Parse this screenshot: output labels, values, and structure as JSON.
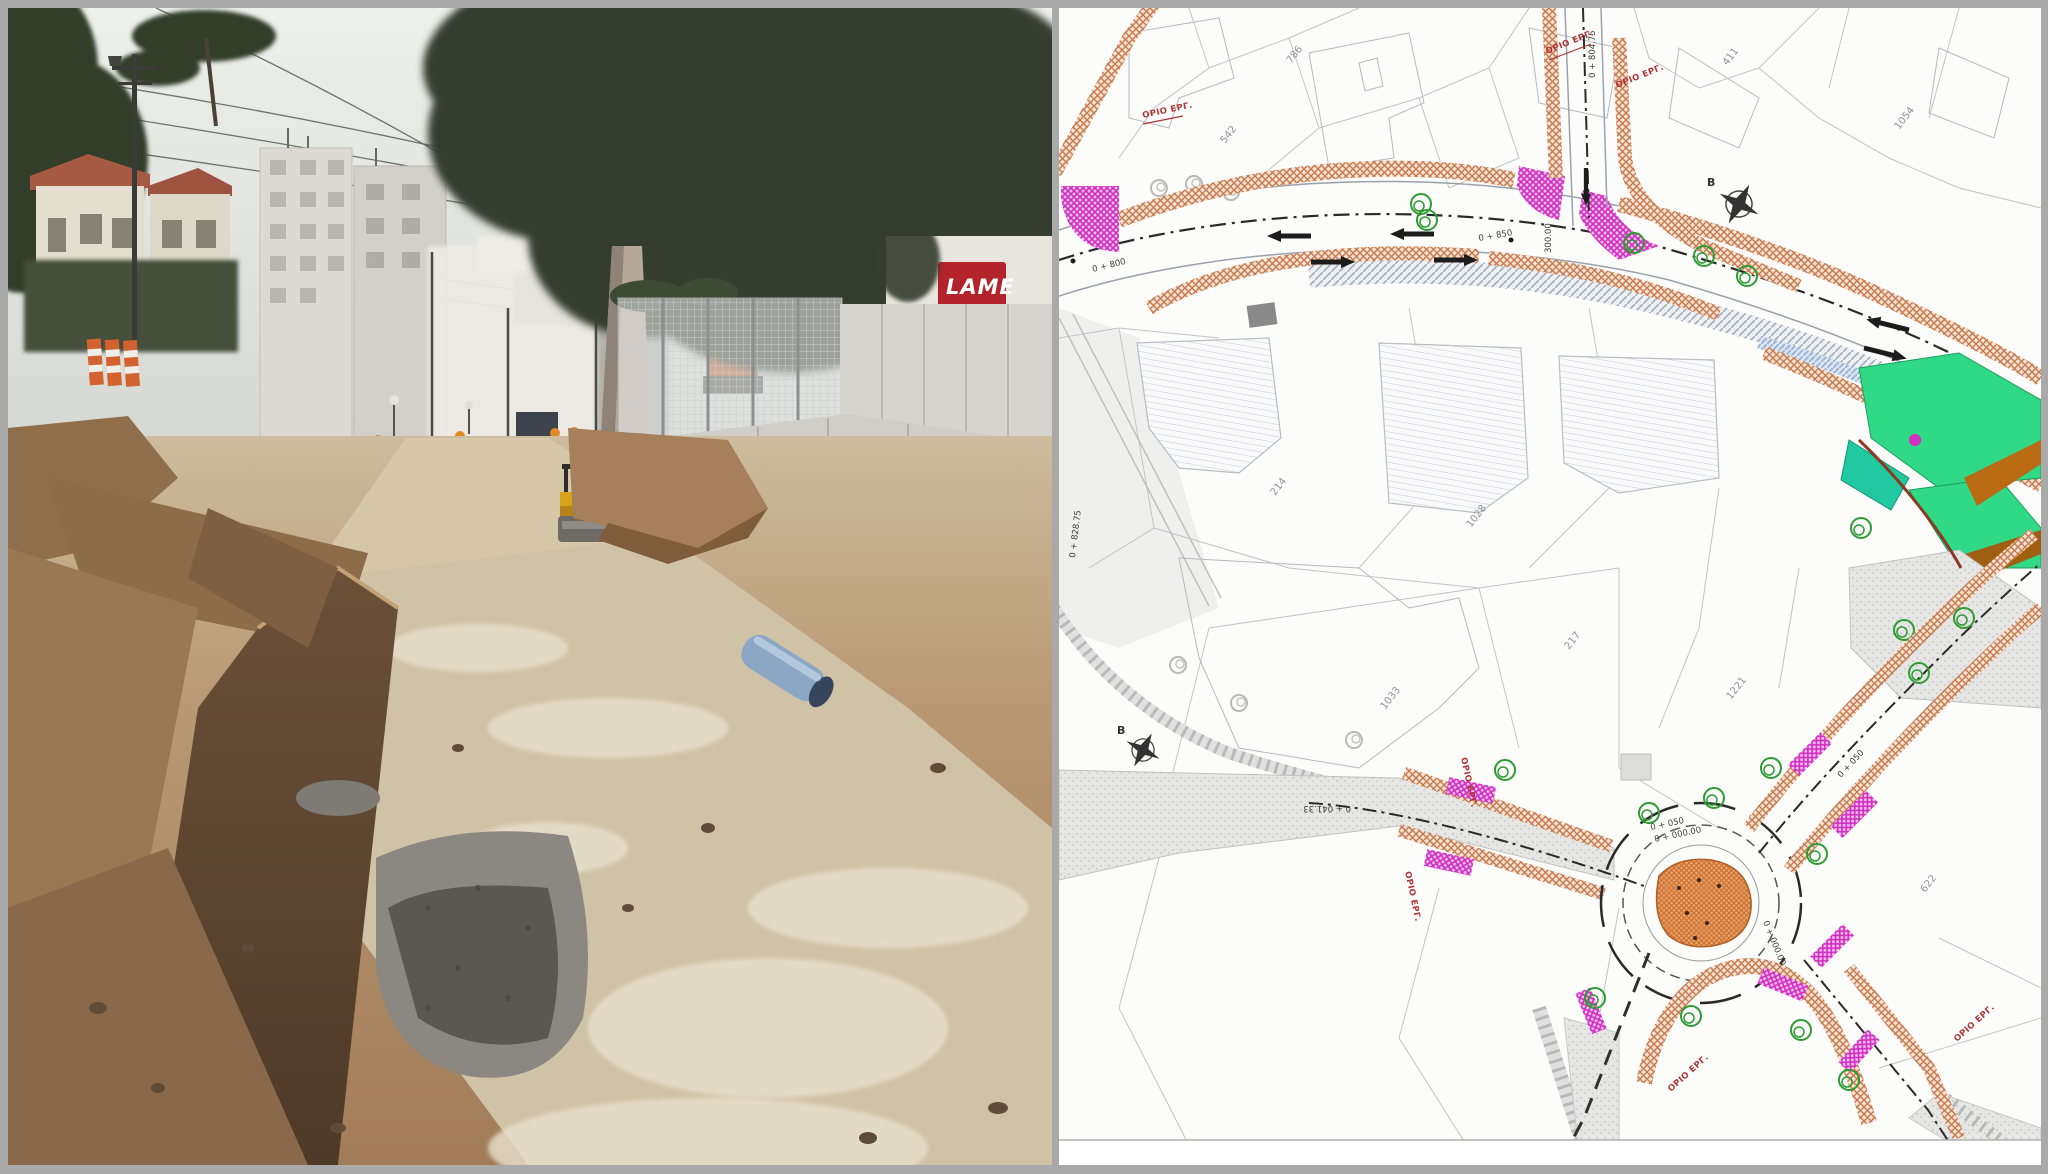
{
  "frame": {
    "border_color": "#a9a9a9"
  },
  "photo": {
    "description": "street reconstruction works with excavated trench, roller and excavator",
    "shop_sign": "LAME"
  },
  "plan": {
    "orio_label": "ΟΡΙΟ ΕΡΓ.",
    "north_label": "B",
    "parcels": [
      "786",
      "542",
      "411",
      "1054",
      "214",
      "1028",
      "217",
      "1221",
      "1033",
      "622"
    ],
    "chainage": {
      "c800": "0 + 800",
      "c850": "0 + 850",
      "c80475": "0 + 804.75",
      "c82875": "0 + 828.75",
      "c04133": "0 + 041.33",
      "c30000": "300.00",
      "c050": "0 + 050",
      "c000": "0 + 000.00",
      "cne050": "0 + 050"
    },
    "colors": {
      "sidewalk_hatch": "#c4794e",
      "pedestrian_crossing": "#d32fc0",
      "tree_symbol": "#2e9b33",
      "green_area": "#2fd985",
      "orange_strip": "#b96a12",
      "roundabout_island": "#e09a62",
      "work_limit_text": "#b03434",
      "existing_road": "#d9d9d7"
    }
  },
  "photo_colors": {
    "sign_red": "#b3232b",
    "machine_yellow": "#d9a21c",
    "excavator_orange": "#c06030",
    "pipe_blue": "#8ba7c4"
  }
}
